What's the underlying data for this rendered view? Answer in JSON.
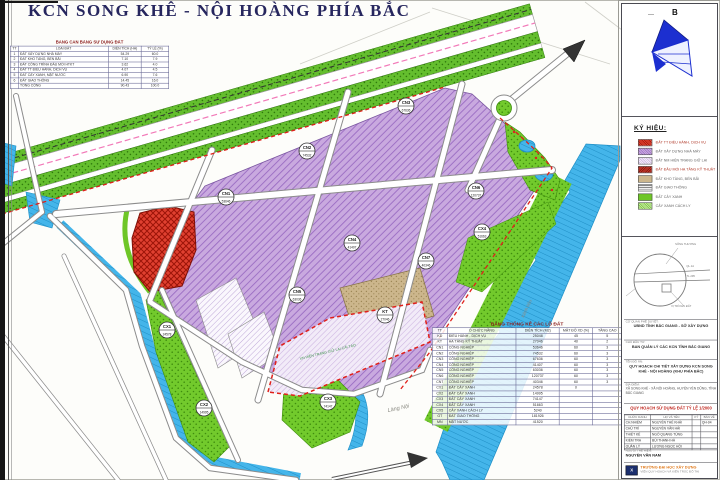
{
  "page": {
    "title": "KCN SONG KHÊ - NỘI HOÀNG PHÍA BẮC"
  },
  "north": {
    "label": "B"
  },
  "landuse_table": {
    "title": "BẢNG CÂN BẰNG SỬ DỤNG ĐẤT",
    "headers": [
      "TT",
      "LOẠI ĐẤT",
      "DIỆN TÍCH (HA)",
      "TỶ LỆ (%)"
    ],
    "rows": [
      [
        "1",
        "ĐẤT XÂY DỰNG NHÀ MÁY",
        "54.29",
        "60.0"
      ],
      [
        "2",
        "ĐẤT KHO TÀNG, BẾN BÃI",
        "7.10",
        "7.9"
      ],
      [
        "3",
        "ĐẤT CÔNG TRÌNH ĐẦU MỐI HTKT",
        "3.62",
        "4.0"
      ],
      [
        "4",
        "ĐẤT TT ĐIỀU HÀNH, DỊCH VỤ",
        "4.07",
        "4.5"
      ],
      [
        "5",
        "ĐẤT CÂY XANH, MẶT NƯỚC",
        "6.90",
        "7.6"
      ],
      [
        "6",
        "ĐẤT GIAO THÔNG",
        "14.45",
        "16.0"
      ],
      [
        "",
        "TỔNG CỘNG",
        "90.43",
        "100.0"
      ]
    ]
  },
  "legend": {
    "title": "KÝ HIỆU:",
    "items": [
      {
        "swatch": "red-hatch",
        "label": "ĐẤT TT ĐIỀU HÀNH, DỊCH VỤ"
      },
      {
        "swatch": "purple",
        "label": "ĐẤT XÂY DỰNG NHÀ MÁY"
      },
      {
        "swatch": "purple-light",
        "label": "ĐẤT NM HIỆN TRẠNG GIỮ LẠI"
      },
      {
        "swatch": "darkred",
        "label": "ĐẤT ĐẦU MỐI HẠ TẦNG KỸ THUẬT"
      },
      {
        "swatch": "tan",
        "label": "ĐẤT KHO TÀNG, BẾN BÃI"
      },
      {
        "swatch": "road",
        "label": "ĐẤT GIAO THÔNG"
      },
      {
        "swatch": "green",
        "label": "ĐẤT CÂY XANH"
      },
      {
        "swatch": "green-light",
        "label": "CÂY XANH CÁCH LY"
      }
    ]
  },
  "detail": {
    "labels": [
      "SÔNG THƯƠNG",
      "QL.1A",
      "TL.295",
      "VỊ TRÍ KHU ĐẤT"
    ]
  },
  "lots_table": {
    "title": "BẢNG THỐNG KÊ CÁC LÔ ĐẤT",
    "headers": [
      "TT",
      "Ô CHỨC NĂNG",
      "DIỆN TÍCH (M2)",
      "MẬT ĐỘ XD (%)",
      "TẦNG CAO"
    ],
    "rows": [
      [
        "KD",
        "ĐIỀU HÀNH - DỊCH VỤ",
        "25048",
        "45",
        "5"
      ],
      [
        "KT",
        "HẠ TẦNG KỸ THUẬT",
        "27046",
        "40",
        "2"
      ],
      [
        "CN1",
        "CÔNG NGHIỆP",
        "53646",
        "60",
        "3"
      ],
      [
        "CN2",
        "CÔNG NGHIỆP",
        "74532",
        "60",
        "3"
      ],
      [
        "CN3",
        "CÔNG NGHIỆP",
        "67636",
        "60",
        "3"
      ],
      [
        "CN4",
        "CÔNG NGHIỆP",
        "41407",
        "60",
        "3"
      ],
      [
        "CN5",
        "CÔNG NGHIỆP",
        "63036",
        "60",
        "3"
      ],
      [
        "CN6",
        "CÔNG NGHIỆP",
        "120737",
        "60",
        "3"
      ],
      [
        "CN7",
        "CÔNG NGHIỆP",
        "40346",
        "60",
        "3"
      ],
      [
        "CX1",
        "ĐẤT CÂY XANH",
        "24578",
        "0",
        ""
      ],
      [
        "CX2",
        "ĐẤT CÂY XANH",
        "14995",
        "",
        ""
      ],
      [
        "CX3",
        "ĐẤT CÂY XANH",
        "74147",
        "",
        ""
      ],
      [
        "CX4",
        "ĐẤT CÂY XANH",
        "51663",
        "",
        ""
      ],
      [
        "CX5",
        "CÂY XANH CÁCH LY",
        "5240",
        "",
        ""
      ],
      [
        "GT",
        "ĐẤT GIAO THÔNG",
        "181926",
        "",
        ""
      ],
      [
        "MN",
        "MẶT NƯỚC",
        "41520",
        "",
        ""
      ]
    ]
  },
  "titleblock": {
    "sections": [
      {
        "label": "CƠ QUAN PHÊ DUYỆT:",
        "text": "UBND TỈNH BẮC GIANG - SỞ XÂY DỰNG"
      },
      {
        "label": "CHỦ ĐẦU TƯ:",
        "text": "BAN QUẢN LÝ CÁC KCN TỈNH BẮC GIANG"
      },
      {
        "label": "TÊN ĐỒ ÁN:",
        "text": "QUY HOẠCH CHI TIẾT XÂY DỰNG KCN SONG KHÊ - NỘI HOÀNG (KHU PHÍA BẮC)"
      },
      {
        "label": "ĐỊA ĐIỂM:",
        "text": "XÃ SONG KHÊ - XÃ NỘI HOÀNG, HUYỆN YÊN DŨNG, TỈNH BẮC GIANG"
      }
    ],
    "drawing_title": "QUY HOẠCH SỬ DỤNG ĐẤT TỶ LỆ 1/2000",
    "staff_table": {
      "headers": [
        "CHỨC DANH",
        "HỌ VÀ TÊN",
        "KÝ",
        "BẢN VẼ"
      ],
      "rows": [
        [
          "CH.NHIỆM",
          "NGUYỄN THẾ KHẢI",
          "",
          "QH-04"
        ],
        [
          "CHỦ TRÌ",
          "NGUYỄN VĂN HẢI",
          "",
          ""
        ],
        [
          "THIẾT KẾ",
          "NGÔ QUANG TÙNG",
          "",
          ""
        ],
        [
          "KIỂM TRA",
          "BÙI THANH HÀ",
          "",
          ""
        ],
        [
          "QUẢN LÝ",
          "LƯƠNG NGỌC HỘI",
          "",
          ""
        ]
      ]
    },
    "note_label": "NGƯỜI THỂ HIỆN:",
    "note_name": "NGUYỄN VĂN NAM",
    "logo_glyph": "X",
    "org": "TRƯỜNG ĐẠI HỌC XÂY DỰNG",
    "org_sub": "VIỆN QUY HOẠCH VÀ KIẾN TRÚC ĐÔ THỊ"
  },
  "map": {
    "parcels": [
      {
        "code": "CN1",
        "area": "53646"
      },
      {
        "code": "CN2",
        "area": "74532"
      },
      {
        "code": "CN3",
        "area": "67636"
      },
      {
        "code": "CN4",
        "area": "41407"
      },
      {
        "code": "CN5",
        "area": "63036"
      },
      {
        "code": "CN6",
        "area": "120737"
      },
      {
        "code": "CN7",
        "area": "40346"
      },
      {
        "code": "KT",
        "area": "27046"
      },
      {
        "code": "CX1",
        "area": "24578"
      },
      {
        "code": "CX2",
        "area": "14995"
      },
      {
        "code": "CX3",
        "area": "74147"
      },
      {
        "code": "CX4",
        "area": "51663"
      }
    ],
    "texts": {
      "village": "Làng Nội",
      "canal": "Kênh tiêu",
      "lot_note": "XN HIỆN TRẠNG GIỮ LẠI CẢI TẠO"
    }
  }
}
